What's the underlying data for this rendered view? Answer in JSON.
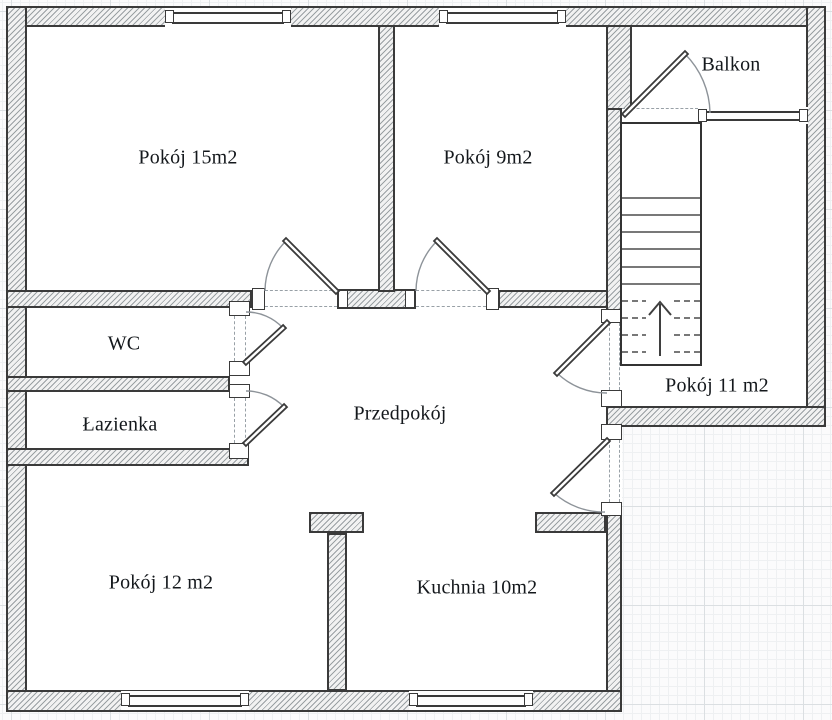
{
  "plan": {
    "type": "apartment-floor-plan",
    "colors": {
      "wall_outline": "#3a3a3a",
      "wall_hatch": "#9aa0a3",
      "floor": "#ffffff",
      "grid_minor": "#eef0f2",
      "grid_major": "#dbdfe2",
      "opening_dash": "#98a0a6",
      "door_arc": "#8d9399",
      "label_text": "#14181c"
    },
    "stairs": {
      "direction_icon": "up-arrow-icon",
      "solid_treads": 6,
      "dashed_treads": 4
    }
  },
  "rooms": [
    {
      "id": "pokoj15",
      "label": "Pokój 15m2"
    },
    {
      "id": "pokoj9",
      "label": "Pokój 9m2"
    },
    {
      "id": "balkon",
      "label": "Balkon"
    },
    {
      "id": "wc",
      "label": "WC"
    },
    {
      "id": "lazienka",
      "label": "Łazienka"
    },
    {
      "id": "przedpokoj",
      "label": "Przedpokój"
    },
    {
      "id": "pokoj11",
      "label": "Pokój 11 m2"
    },
    {
      "id": "pokoj12",
      "label": "Pokój 12 m2"
    },
    {
      "id": "kuchnia",
      "label": "Kuchnia 10m2"
    }
  ]
}
